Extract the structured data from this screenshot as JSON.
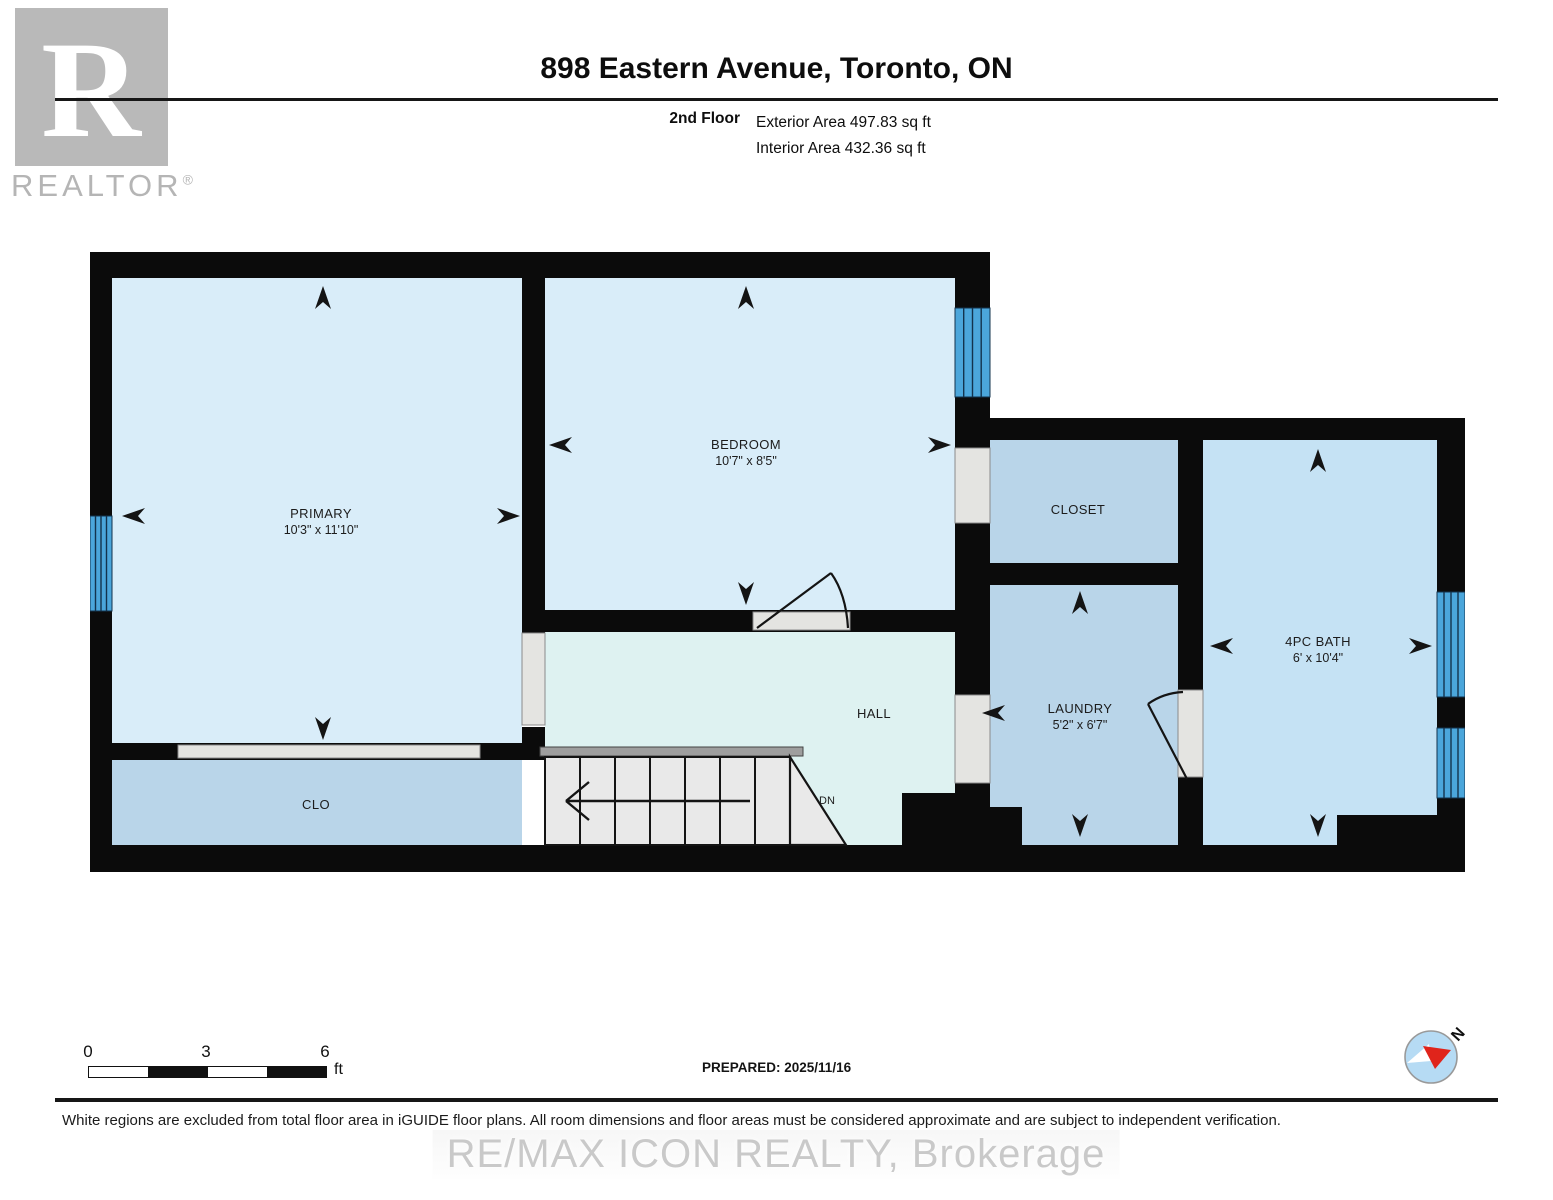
{
  "header": {
    "logo": {
      "letter": "R",
      "wordmark": "REALTOR",
      "registered": "®"
    },
    "title": "898 Eastern Avenue, Toronto, ON",
    "floor_label": "2nd Floor",
    "exterior_area": "Exterior Area 497.83 sq ft",
    "interior_area": "Interior Area 432.36 sq ft"
  },
  "floorplan": {
    "rooms": {
      "primary": {
        "name": "PRIMARY",
        "dims": "10'3\" x 11'10\""
      },
      "bedroom": {
        "name": "BEDROOM",
        "dims": "10'7\" x 8'5\""
      },
      "closet": {
        "name": "CLOSET"
      },
      "laundry": {
        "name": "LAUNDRY",
        "dims": "5'2\" x 6'7\""
      },
      "bath": {
        "name": "4PC BATH",
        "dims": "6' x 10'4\""
      },
      "hall": {
        "name": "HALL"
      },
      "clo": {
        "name": "CLO"
      }
    },
    "stairs": {
      "direction_label": "DN"
    },
    "colors": {
      "wall": "#0b0b0b",
      "room_light_blue": "#d9edf9",
      "room_medium_blue": "#b9d5e9",
      "room_bath_blue": "#c5e2f4",
      "hall_mint": "#def2f1",
      "window_blue": "#4ba6db",
      "opening_gray": "#e4e4e1",
      "stair_gray": "#e9e9e9"
    }
  },
  "scale_bar": {
    "ticks": [
      "0",
      "3",
      "6"
    ],
    "unit": "ft"
  },
  "prepared_label": "PREPARED: 2025/11/16",
  "compass": {
    "north_label": "N"
  },
  "footer": {
    "disclaimer": "White regions are excluded from total floor area in iGUIDE floor plans. All room dimensions and floor areas must be considered approximate and are subject to independent verification."
  },
  "watermark": "RE/MAX ICON REALTY, Brokerage"
}
